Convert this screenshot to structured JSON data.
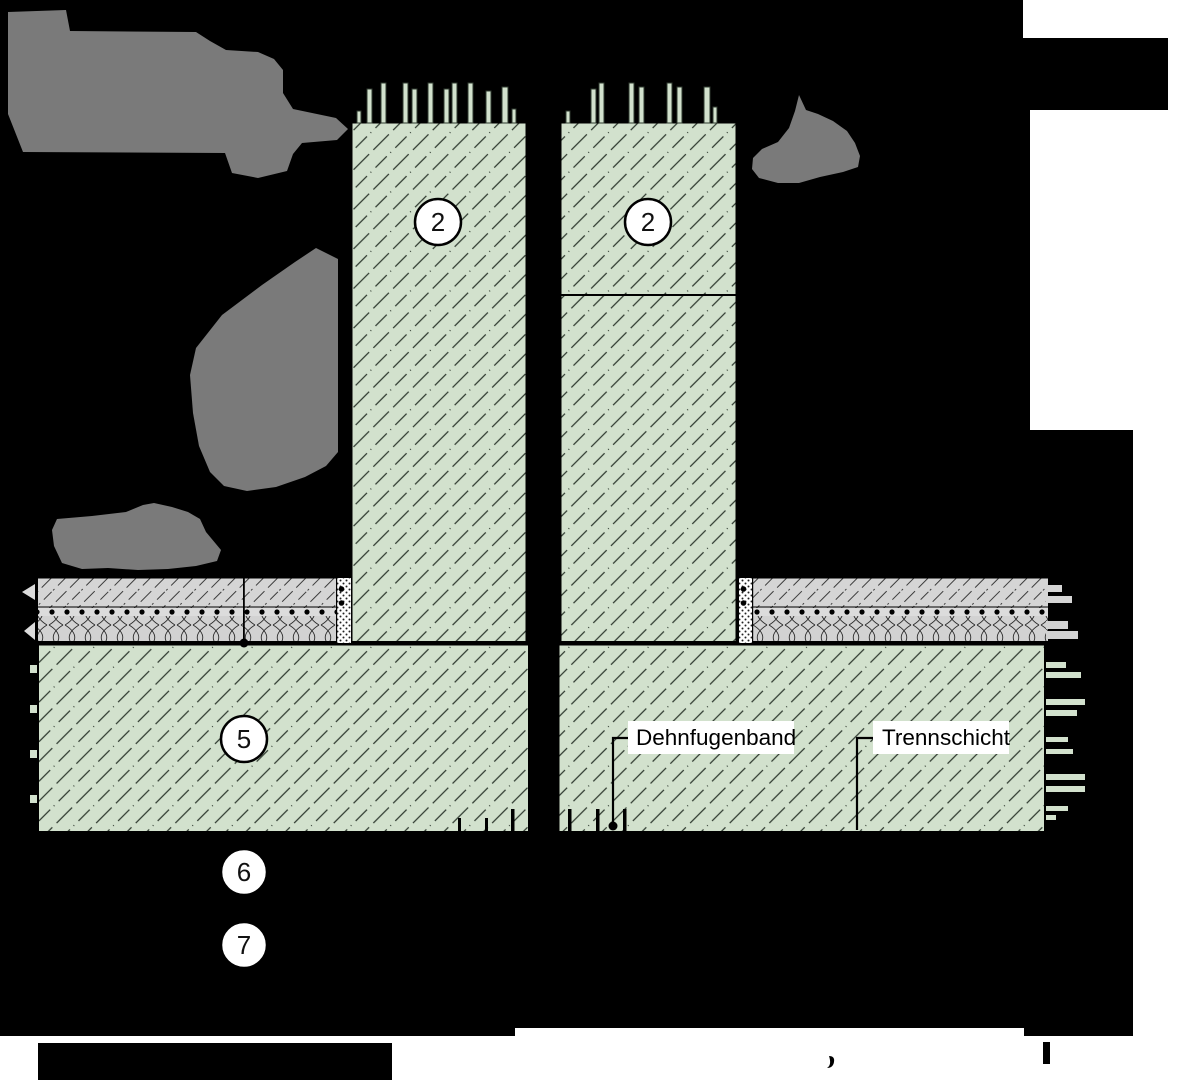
{
  "drawing": {
    "callouts": {
      "wall_left": "2",
      "wall_right": "2",
      "slab": "5",
      "below_slab_1": "6",
      "below_slab_2": "7"
    },
    "labels": {
      "dehnfugenband": "Dehnfugenband",
      "trennschicht": "Trennschicht"
    },
    "colors": {
      "background": "#000000",
      "concrete_green": "#d2e1cd",
      "concrete_hatch": "#2f3a30",
      "screed_gray": "#d5d5d5",
      "insulation_gray": "#d2d2d2",
      "erased_blob_gray": "#7a7a7a",
      "paper_white": "#ffffff",
      "line_black": "#000000"
    }
  }
}
